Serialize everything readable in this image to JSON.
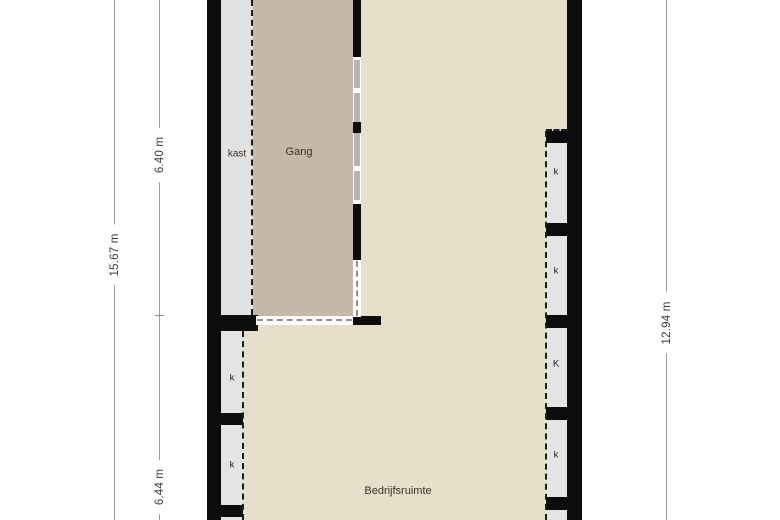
{
  "floor_plan": {
    "type": "architectural-floor-plan",
    "rooms": {
      "kast": "kast",
      "gang": "Gang",
      "bedrijfsruimte": "Bedrijfsruimte"
    },
    "closets": {
      "right": [
        "k",
        "k",
        "K",
        "k"
      ],
      "left": [
        "k",
        "k"
      ]
    },
    "dimensions": {
      "outer_left": "15.67 m",
      "inner_top_left": "6.40 m",
      "inner_bottom_left": "6.44 m",
      "right": "12.94 m"
    },
    "colors": {
      "wall": "#0c0c0c",
      "room_main": "#e6dfca",
      "room_gang": "#c5b8a8",
      "closet_fill": "#e4e4e4",
      "glass": "#b4b4b4",
      "dimension_line": "#9a9a9a",
      "label_text": "#39322b",
      "background": "#ffffff"
    }
  }
}
